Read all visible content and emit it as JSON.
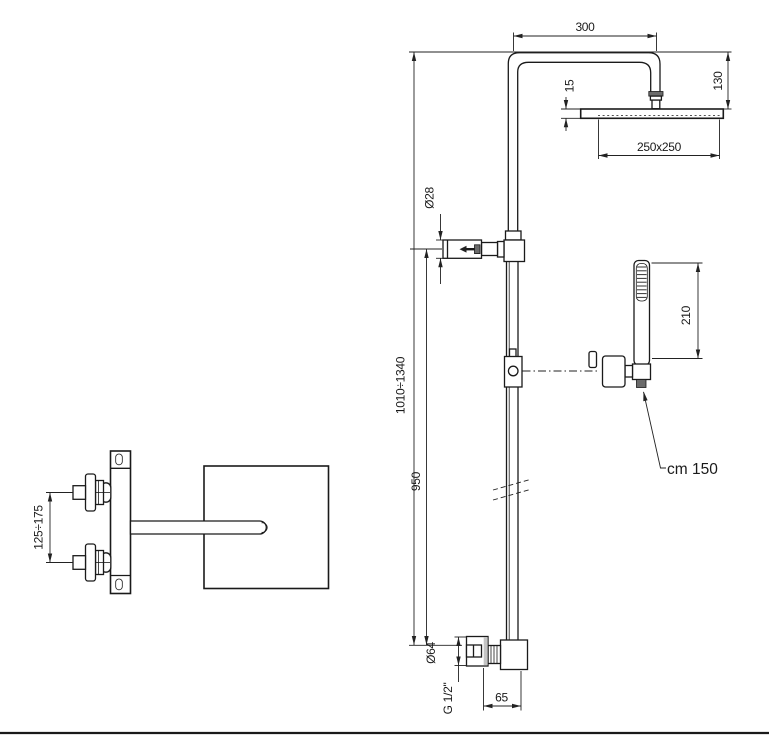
{
  "drawing": {
    "labels": {
      "arm_projection": "300",
      "head_thickness": "15",
      "head_drop": "130",
      "head_size": "250x250",
      "column_diameter": "Ø28",
      "total_height_range": "1010÷1340",
      "column_height": "950",
      "handshower_length": "210",
      "hose_length": "cm 150",
      "escutcheon_diameter": "Ø64",
      "thread_size": "G 1/2\"",
      "outlet_offset": "65",
      "inlet_spacing_range": "125÷175"
    },
    "colors": {
      "line": "#1a1a1a",
      "dimension": "#222222",
      "shading": "#c4c4c4",
      "background": "#ffffff"
    }
  }
}
